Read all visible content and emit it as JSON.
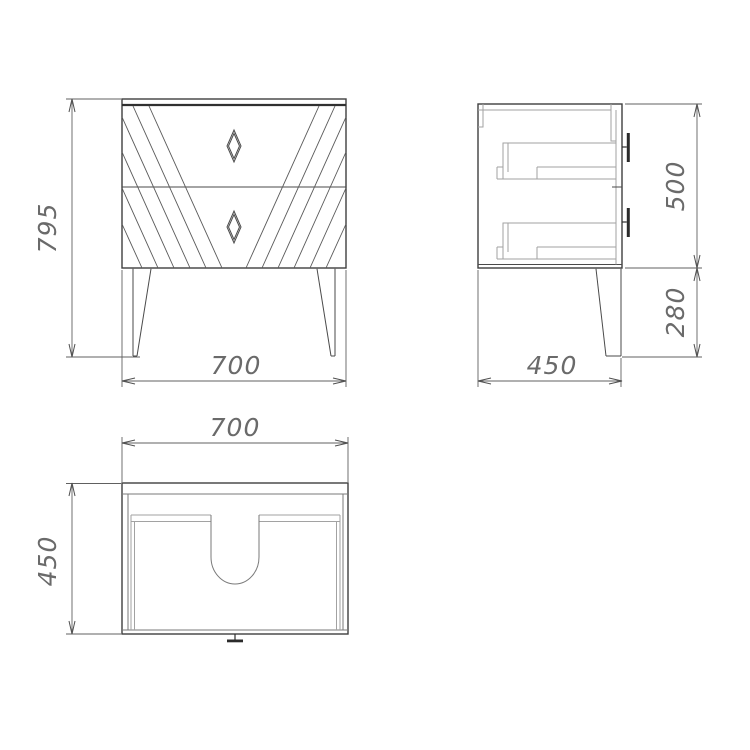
{
  "dimensions": {
    "front_height": "795",
    "front_width": "700",
    "side_body_height": "500",
    "side_leg_height": "280",
    "side_depth": "450",
    "top_width": "700",
    "top_depth": "450"
  },
  "colors": {
    "object_line": "#3f3f3f",
    "internal_line": "#a2a2a2",
    "dimension_line": "#606060",
    "dimension_text": "#6a6a6a",
    "background": "#ffffff"
  }
}
